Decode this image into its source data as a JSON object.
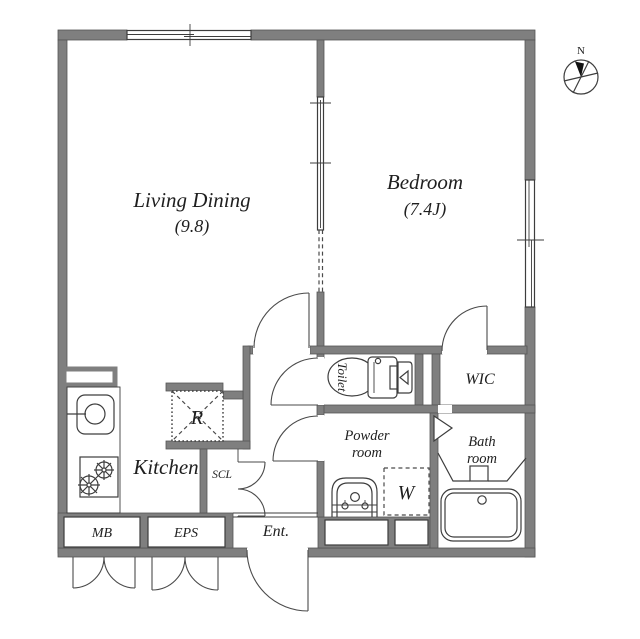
{
  "plan": {
    "type": "apartment-floor-plan",
    "colors": {
      "wall": "#7f7f7f",
      "line": "#3d3d3d",
      "text": "#1f1f1f",
      "background": "#ffffff"
    },
    "rooms": {
      "living": {
        "name": "Living Dining",
        "area": "(9.8)"
      },
      "bedroom": {
        "name": "Bedroom",
        "area": "(7.4J)"
      },
      "kitchen": {
        "name": "Kitchen"
      },
      "toilet": {
        "name": "Toilet"
      },
      "wic": {
        "name": "WIC"
      },
      "powder": {
        "name_line1": "Powder",
        "name_line2": "room"
      },
      "bath": {
        "name_line1": "Bath",
        "name_line2": "room"
      },
      "entrance": {
        "name": "Ent."
      },
      "scl": {
        "name": "SCL"
      },
      "mb": {
        "name": "MB"
      },
      "eps": {
        "name": "EPS"
      },
      "washer": {
        "name": "W"
      },
      "fridge": {
        "name": "R"
      }
    },
    "compass": {
      "north_label": "N"
    }
  }
}
